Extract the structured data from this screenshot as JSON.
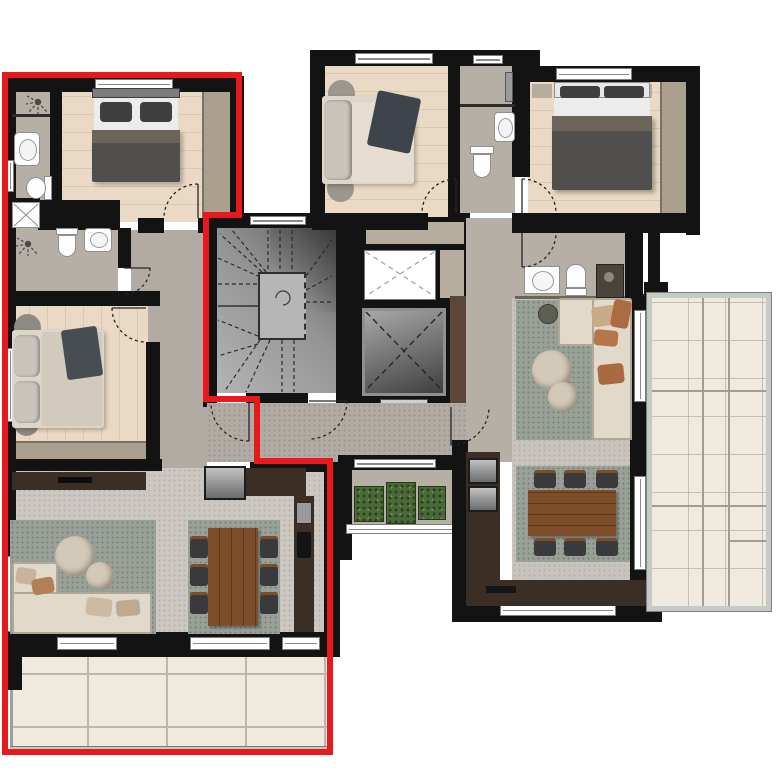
{
  "canvas": {
    "width": 780,
    "height": 780,
    "background": "#ffffff"
  },
  "plan": {
    "type": "residential-floor-plan",
    "units": [
      {
        "id": "unit-a",
        "highlighted": true,
        "boundary_color": "#e8191d",
        "rooms": [
          "bedroom-1",
          "ensuite-bathroom",
          "bathroom-2",
          "bedroom-2",
          "hallway",
          "living-dining-kitchen",
          "balcony"
        ]
      },
      {
        "id": "unit-b",
        "highlighted": false,
        "rooms": [
          "bedroom-3",
          "bathroom-3",
          "bedroom-4",
          "bathroom-4",
          "hallway",
          "living-room",
          "dining-kitchen",
          "terrace"
        ]
      }
    ],
    "common_areas": [
      "winding-staircase",
      "elevator",
      "light-well",
      "corridor",
      "planter-court"
    ]
  },
  "colors": {
    "wall": "#131313",
    "red": "#e8191d",
    "wood": "#ead9c4",
    "bath": "#b6afa6",
    "corr": "#b2aba3",
    "living": "#ccc7c0",
    "living2": "#c8c3bc",
    "rug": "#98a098",
    "sofa": "#e1d9ca",
    "taupe": "#aba08e",
    "cabinet": "#b6ad9f",
    "kitchen": "#3a2e25",
    "wood_table": "#7c4e29",
    "chair": "#3a3a3c",
    "tile": "#efe9de",
    "tile_line": "#bdb6aa",
    "rail": "#c6cac6",
    "planter": "#4c6a39",
    "blanket": "#514f4d",
    "fold": "#6d6459",
    "white_bed": "#ececec",
    "pillow": "#3e3e40",
    "rust": "#ad6b42",
    "pouf": "#d3c9b8",
    "stair_dark": "#5f5f5f",
    "stair_light": "#b4b4b4",
    "panel_brown": "#5b4637"
  },
  "icons": [
    "shower-icon",
    "toilet-icon",
    "sink-icon",
    "elevator-x-icon",
    "lightwell-x-icon",
    "door-swing-icon",
    "stair-treads-icon"
  ]
}
